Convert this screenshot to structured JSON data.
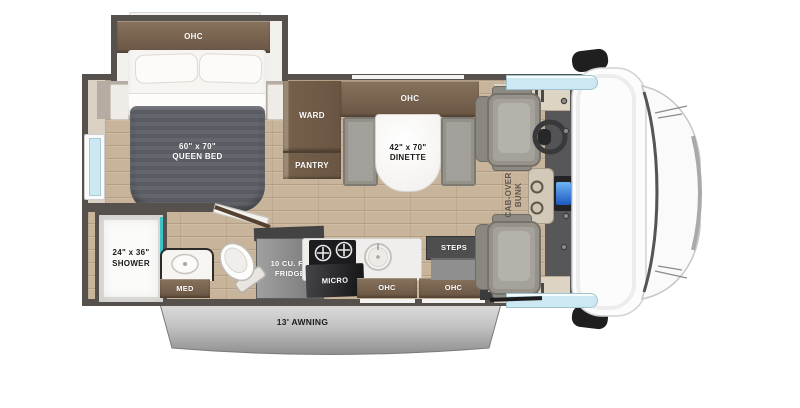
{
  "labels": {
    "bedroom_ohc": "OHC",
    "bed_size": "60\" x 70\"",
    "bed_name": "QUEEN BED",
    "ward": "WARD",
    "pantry": "PANTRY",
    "dinette_ohc": "OHC",
    "dinette_size": "42\" x 70\"",
    "dinette_name": "DINETTE",
    "cabover_line1": "CAB-OVER",
    "cabover_line2": "BUNK",
    "shower_size": "24\" x 36\"",
    "shower_name": "SHOWER",
    "med": "MED",
    "fridge_line1": "10 CU. FT.",
    "fridge_line2": "FRIDGE",
    "micro": "MICRO",
    "kitchen_ohc_left": "OHC",
    "kitchen_ohc_right": "OHC",
    "steps": "STEPS",
    "tv": "TV",
    "awning": "13' AWNING"
  },
  "colors": {
    "wall": "#56514c",
    "floor_wood": "#c8b49b",
    "cabinet_brown": "#6a5543",
    "shower_glass_teal": "#3fc3c6",
    "window_blue": "#cde8f2",
    "radio_screen_blue": "#2f7fdd",
    "awning_gray": "#b9b9b9",
    "duvet_gray": "#61646a"
  }
}
